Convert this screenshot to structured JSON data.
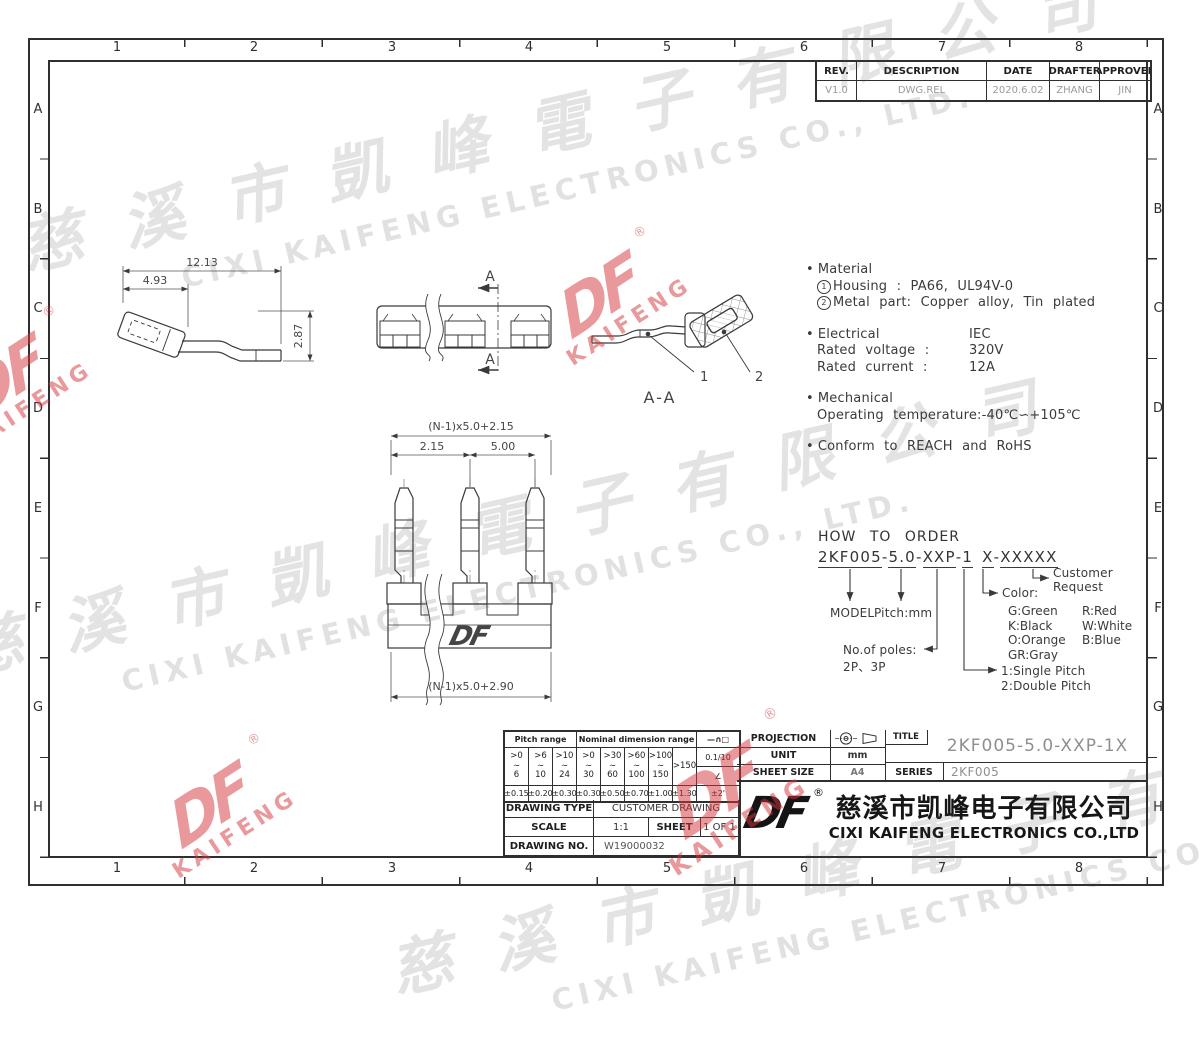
{
  "sheet": {
    "columns": [
      "1",
      "2",
      "3",
      "4",
      "5",
      "6",
      "7",
      "8"
    ],
    "rows": [
      "A",
      "B",
      "C",
      "D",
      "E",
      "F",
      "G",
      "H"
    ]
  },
  "revision": {
    "headers": [
      "REV.",
      "DESCRIPTION",
      "DATE",
      "DRAFTER",
      "APPROVER"
    ],
    "row": [
      "V1.0",
      "DWG.REL",
      "2020.6.02",
      "ZHANG",
      "JIN"
    ]
  },
  "notes": {
    "bullet": "•",
    "material_title": "Material",
    "circled_1": "1",
    "material_1": "Housing : PA66, UL94V-0",
    "circled_2": "2",
    "material_2": "Metal part: Copper alloy, Tin plated",
    "electrical_title": "Electrical",
    "electrical_std": "IEC",
    "voltage_label": "Rated voltage :",
    "voltage_value": "320V",
    "current_label": "Rated current :",
    "current_value": "12A",
    "mechanical_title": "Mechanical",
    "temperature": "Operating temperature:-40℃∽+105℃",
    "conform": "Conform to REACH and RoHS"
  },
  "order": {
    "title": "HOW TO ORDER",
    "segments": [
      "2KF005",
      "-",
      "5.0",
      "-",
      "XXP",
      "-",
      "1",
      "X",
      "-",
      "XXXXX"
    ],
    "model": "MODEL",
    "pitch": "Pitch:mm",
    "poles_label": "No.of poles:",
    "poles_value": "2P、3P",
    "single": "1:Single Pitch",
    "double": "2:Double Pitch",
    "color_label": "Color:",
    "colors": [
      "G:Green",
      "R:Red",
      "K:Black",
      "W:White",
      "O:Orange",
      "B:Blue",
      "GR:Gray"
    ],
    "customer_1": "Customer",
    "customer_2": "Request"
  },
  "dims": {
    "side_overall": "12.13",
    "side_head": "4.93",
    "side_height": "2.87",
    "front_top": "(N-1)x5.0+2.15",
    "front_pitch_a": "2.15",
    "front_pitch_b": "5.00",
    "front_bottom": "(N-1)x5.0+2.90",
    "section_label": "A-A",
    "section_arrow": "A",
    "part_1": "1",
    "part_2": "2"
  },
  "tolerance": {
    "pitch_header": "Pitch range",
    "nominal_header": "Nominal dimension range",
    "symbols": "—∩□",
    "tilde": "∼",
    "ranges": [
      [
        ">0",
        "6"
      ],
      [
        ">6",
        "10"
      ],
      [
        ">10",
        "24"
      ],
      [
        ">0",
        "30"
      ],
      [
        ">30",
        "60"
      ],
      [
        ">60",
        "100"
      ],
      [
        ">100",
        "150"
      ],
      [
        ">150",
        ""
      ]
    ],
    "flatness": "0.1/10",
    "angle": "∠",
    "values": [
      "±0.15",
      "±0.20",
      "±0.30",
      "±0.30",
      "±0.50",
      "±0.70",
      "±1.00",
      "±1.30",
      "±2'"
    ]
  },
  "titleblock": {
    "projection_label": "PROJECTION",
    "unit_label": "UNIT",
    "unit_value": "mm",
    "sheet_size_label": "SHEET SIZE",
    "sheet_size_value": "A4",
    "title_label": "TITLE",
    "title_value": "2KF005-5.0-XXP-1X",
    "series_label": "SERIES",
    "series_value": "2KF005"
  },
  "info": {
    "type_label": "DRAWING TYPE",
    "type_value": "CUSTOMER DRAWING",
    "scale_label": "SCALE",
    "scale_value": "1:1",
    "sheet_label": "SHEET",
    "sheet_value": "1 OF 1",
    "no_label": "DRAWING NO.",
    "no_value": "W19000032"
  },
  "company": {
    "logo": "DF",
    "reg": "®",
    "name_cn": "慈溪市凯峰电子有限公司",
    "name_en": "CIXI KAIFENG ELECTRONICS CO.,LTD"
  },
  "watermark": {
    "cn": "慈溪市凱峰電子有限公司",
    "en": "CIXI KAIFENG ELECTRONICS CO., LTD.",
    "logo": "DF",
    "logo_sub": "KAIFENG",
    "reg": "®"
  }
}
